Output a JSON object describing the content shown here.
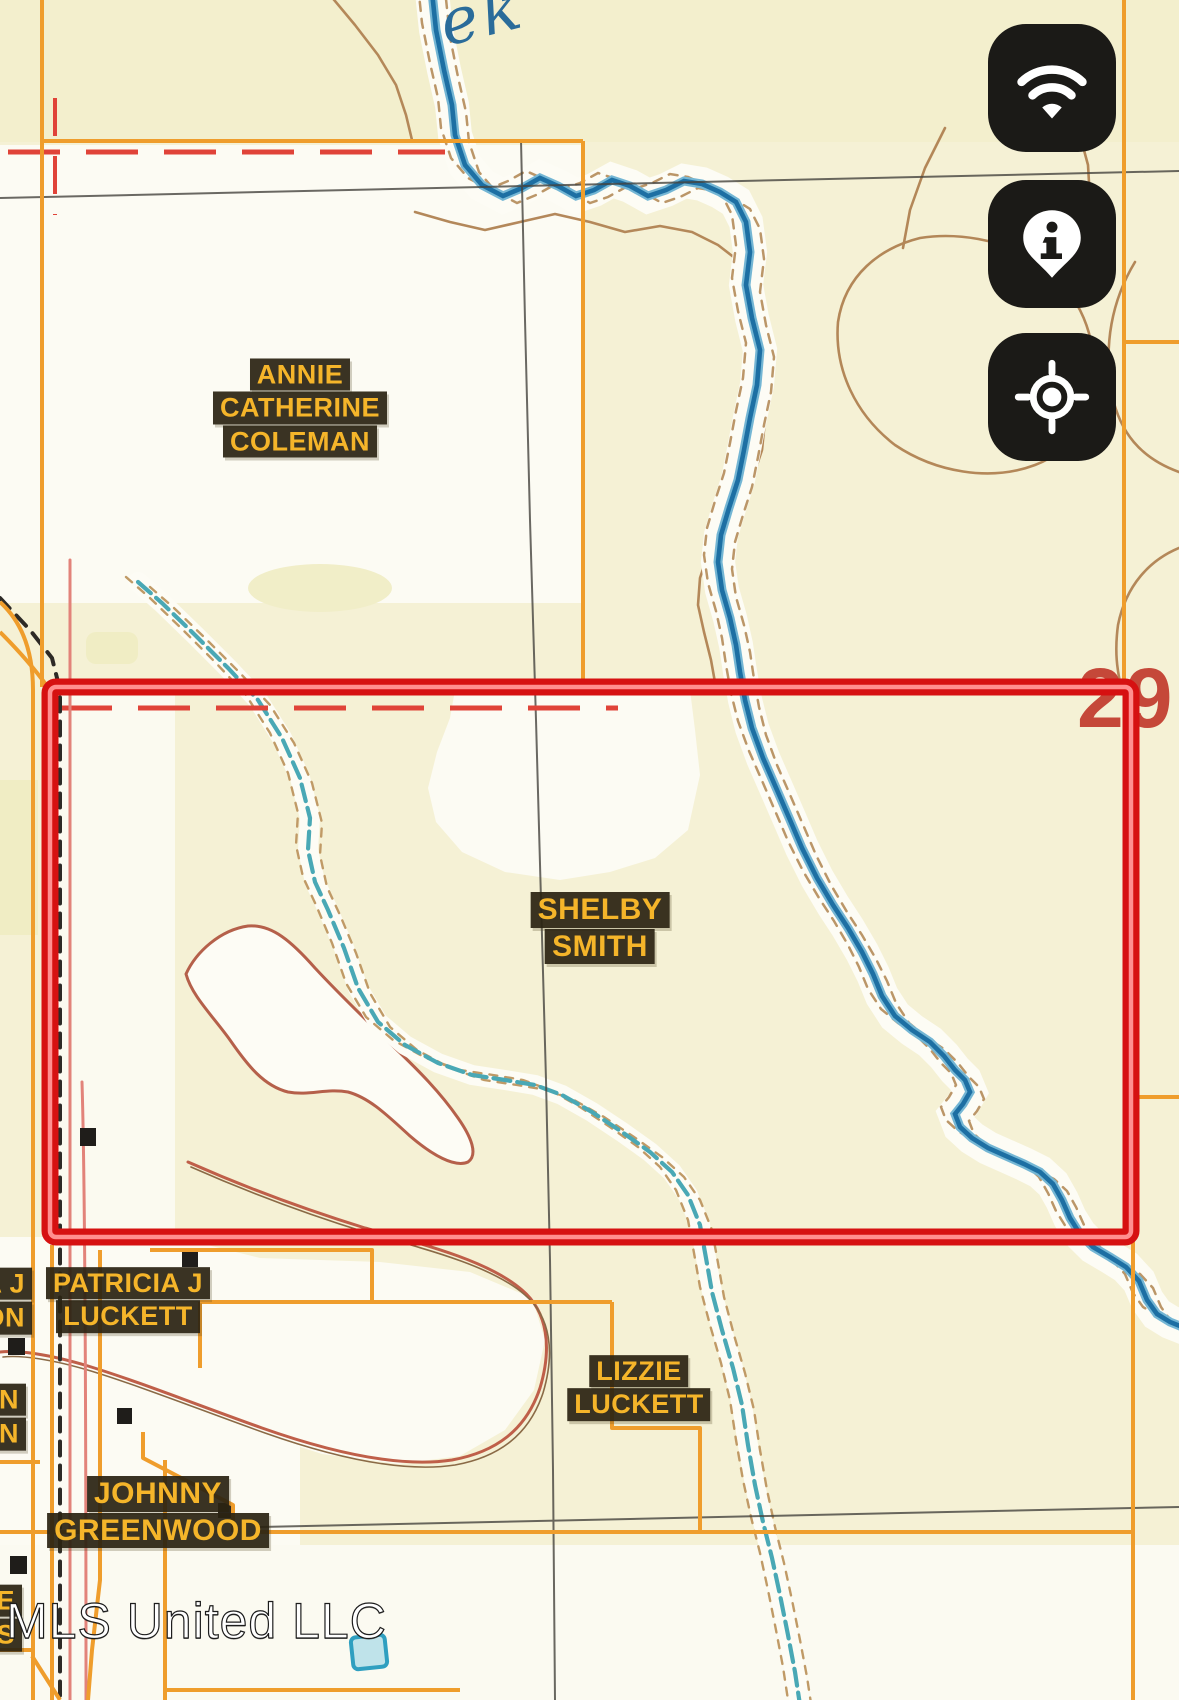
{
  "map": {
    "creek_label_fragment": "ek",
    "section_number": "29",
    "watermark": "MLS United LLC",
    "parcel_labels": {
      "annie": {
        "lines": [
          "ANNIE",
          "CATHERINE",
          "COLEMAN"
        ]
      },
      "shelby": {
        "lines": [
          "SHELBY",
          "SMITH"
        ]
      },
      "patricia": {
        "lines": [
          "PATRICIA J",
          "LUCKETT"
        ]
      },
      "lizzie": {
        "lines": [
          "LIZZIE",
          "LUCKETT"
        ]
      },
      "johnny": {
        "lines": [
          "JOHNNY",
          "GREENWOOD"
        ]
      },
      "edge_fragment_1": {
        "lines": [
          "A J",
          "ON"
        ]
      },
      "edge_fragment_2": {
        "lines": [
          "N",
          "N"
        ]
      },
      "edge_fragment_3": {
        "lines": [
          "IE",
          "IS"
        ]
      }
    },
    "colors": {
      "background": "#f5f1d5",
      "label_text": "#f5b52a",
      "label_bg": "#2b2312",
      "highlight_box": "#d61111",
      "parcel_line": "#ef9d2c",
      "creek": "#1d6fa3",
      "tributary": "#49a8b5",
      "contour": "#b08252",
      "section_number_color": "#c23a2c"
    }
  },
  "controls": {
    "buttons": [
      {
        "icon": "wifi-icon"
      },
      {
        "icon": "info-pin-icon"
      },
      {
        "icon": "locate-icon"
      }
    ]
  }
}
